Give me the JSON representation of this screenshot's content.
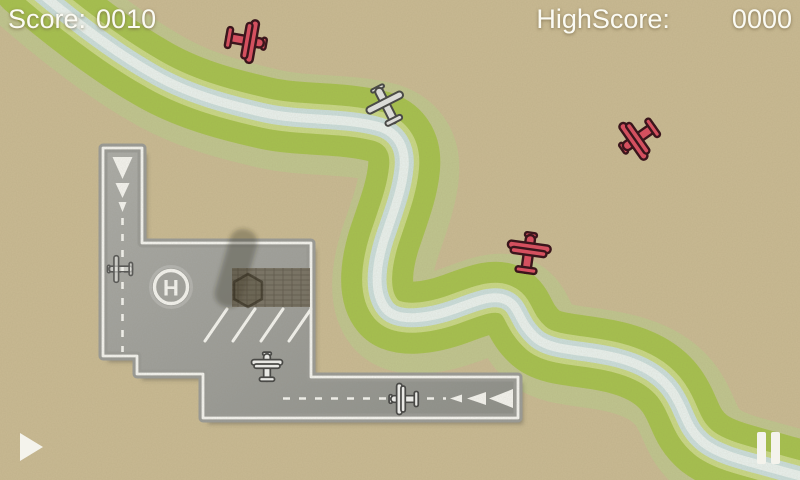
{
  "hud": {
    "score_label": "Score:",
    "score_value": "0010",
    "highscore_label": "HighScore:",
    "highscore_value": "0000"
  },
  "airport": {
    "helipad_letter": "H"
  },
  "buttons": {
    "play_icon": "play-triangle",
    "pause_icon": "pause-bars"
  },
  "colors": {
    "sand": "#c9ba93",
    "grass": "#a6c14e",
    "grass_halo": "#bccb8d",
    "grass_rim": "#c9d886",
    "river_outer": "#cbdedc",
    "river_inner": "#e9f1ee",
    "tarmac_light": "#abaca8",
    "tarmac_dark": "#8d8f8a",
    "marking_white": "#f4f4f0",
    "red_plane": "#d4505f",
    "red_plane_outline": "#3a161c",
    "white_plane": "#dbdbd7",
    "white_plane_outline": "#4a4a47",
    "hud_text": "#fbfbf4",
    "button_white": "#f4f3ec"
  },
  "planes": [
    {
      "id": "red-biplane-1",
      "type": "enemy-red-biplane",
      "symbol": "#sym-red-biplane",
      "transform": "translate(243,40) rotate(100)"
    },
    {
      "id": "red-biplane-2",
      "type": "enemy-red-biplane",
      "symbol": "#sym-red-biplane",
      "transform": "translate(641,136) rotate(235)"
    },
    {
      "id": "red-biplane-3",
      "type": "enemy-red-biplane",
      "symbol": "#sym-red-biplane",
      "transform": "translate(528,256) rotate(8)"
    },
    {
      "id": "white-plane-flying",
      "type": "white-prop-plane",
      "symbol": "#sym-white-prop",
      "transform": "translate(387,107) rotate(-27)"
    },
    {
      "id": "white-plane-apron",
      "type": "white-biplane",
      "symbol": "#sym-white-biplane",
      "transform": "translate(267,369) scale(0.72)"
    },
    {
      "id": "white-plane-runway",
      "type": "white-biplane",
      "symbol": "#sym-white-biplane",
      "transform": "translate(406,399) rotate(-90) scale(0.72)"
    },
    {
      "id": "ghost-plane-taxi",
      "type": "ghost-small-plane",
      "symbol": "#sym-ghost-plane",
      "transform": "translate(122,269) rotate(-90) scale(0.62)"
    }
  ]
}
